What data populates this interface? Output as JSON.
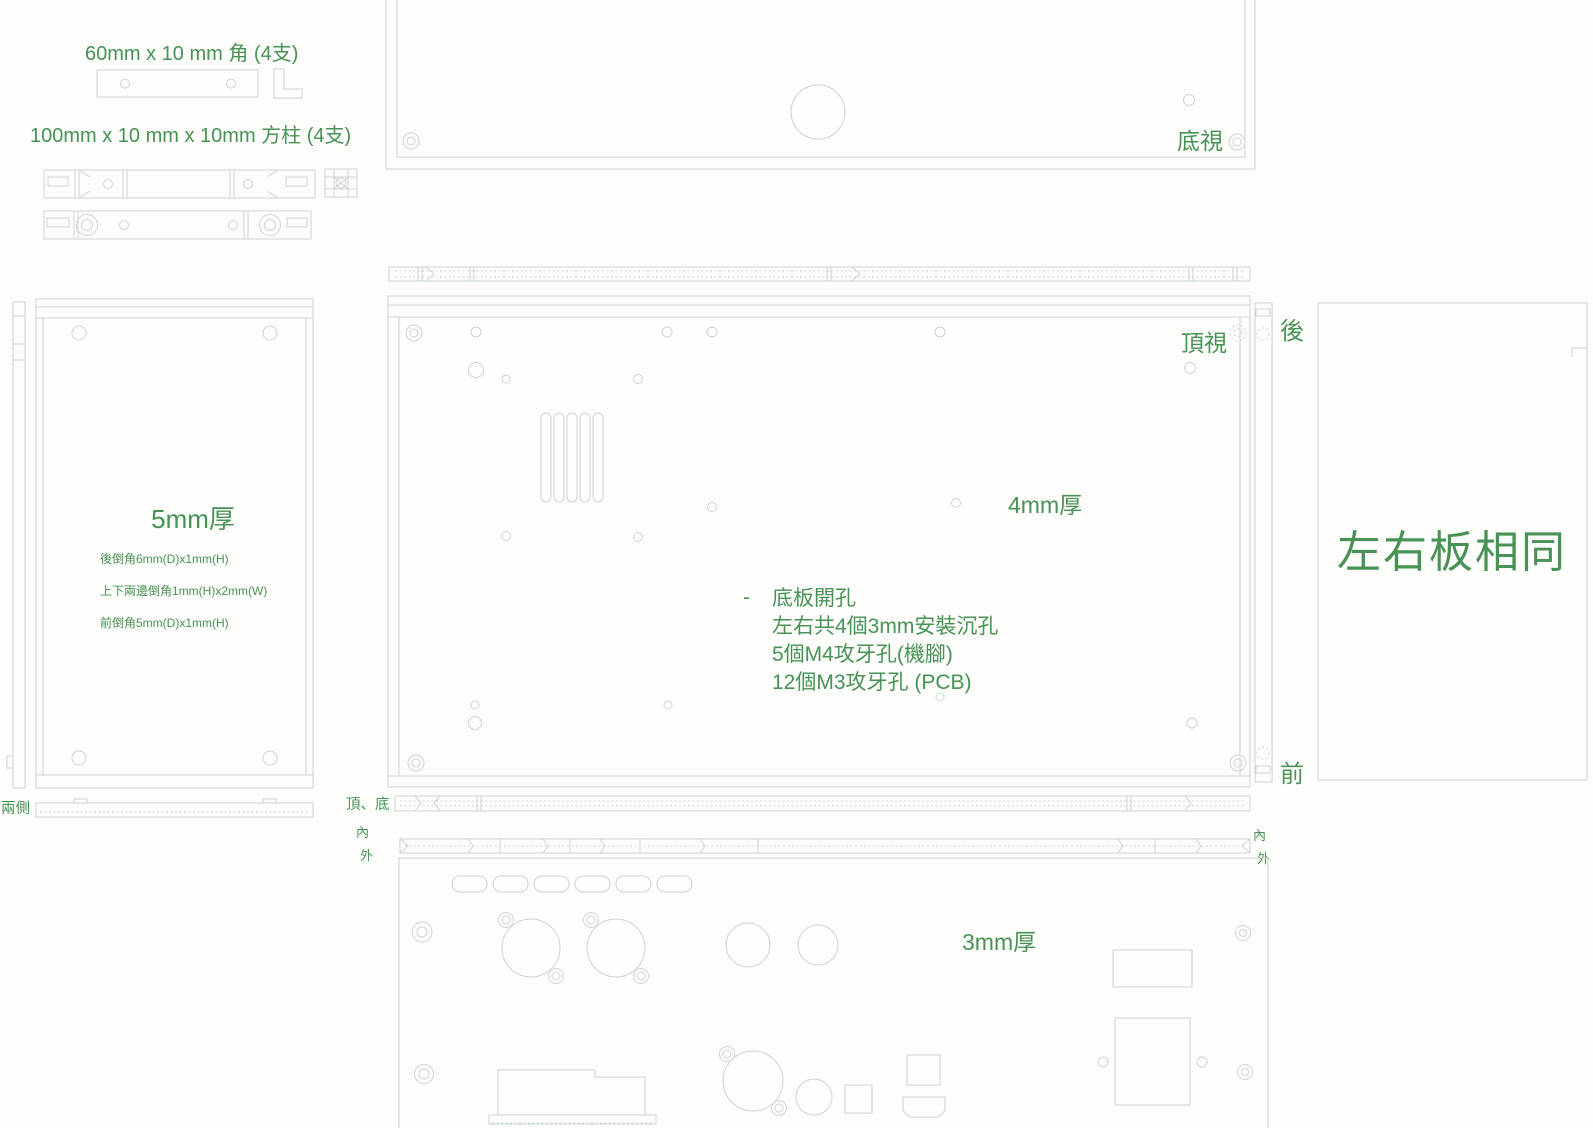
{
  "drawing": {
    "colors": {
      "background": "#fdfdfc",
      "line": "#ccd5cd",
      "text_green": "#479254"
    },
    "parts": {
      "angle_label": "60mm x 10 mm 角 (4支)",
      "rod_label": "100mm x 10 mm x 10mm 方柱 (4支)"
    },
    "side_view": {
      "thickness": "5mm厚",
      "note_rear_chamfer": "後倒角6mm(D)x1mm(H)",
      "note_edge_chamfer": "上下兩邊倒角1mm(H)x2mm(W)",
      "note_front_chamfer": "前倒角5mm(D)x1mm(H)",
      "strip_label": "兩側"
    },
    "top_view": {
      "view_label": "頂視",
      "thickness": "4mm厚",
      "bullet": "-",
      "note_title": "底板開孔",
      "note_line1": "左右共4個3mm安裝沉孔",
      "note_line2": "5個M4攻牙孔(機腳)",
      "note_line3": "12個M3攻牙孔 (PCB)",
      "rear": "後",
      "front": "前"
    },
    "bottom_view": {
      "view_label": "底視"
    },
    "edge_views": {
      "top_bottom_label": "頂、底",
      "inner": "內",
      "outer": "外"
    },
    "rear_view": {
      "thickness": "3mm厚"
    },
    "right_view": {
      "note": "左右板相同"
    }
  }
}
